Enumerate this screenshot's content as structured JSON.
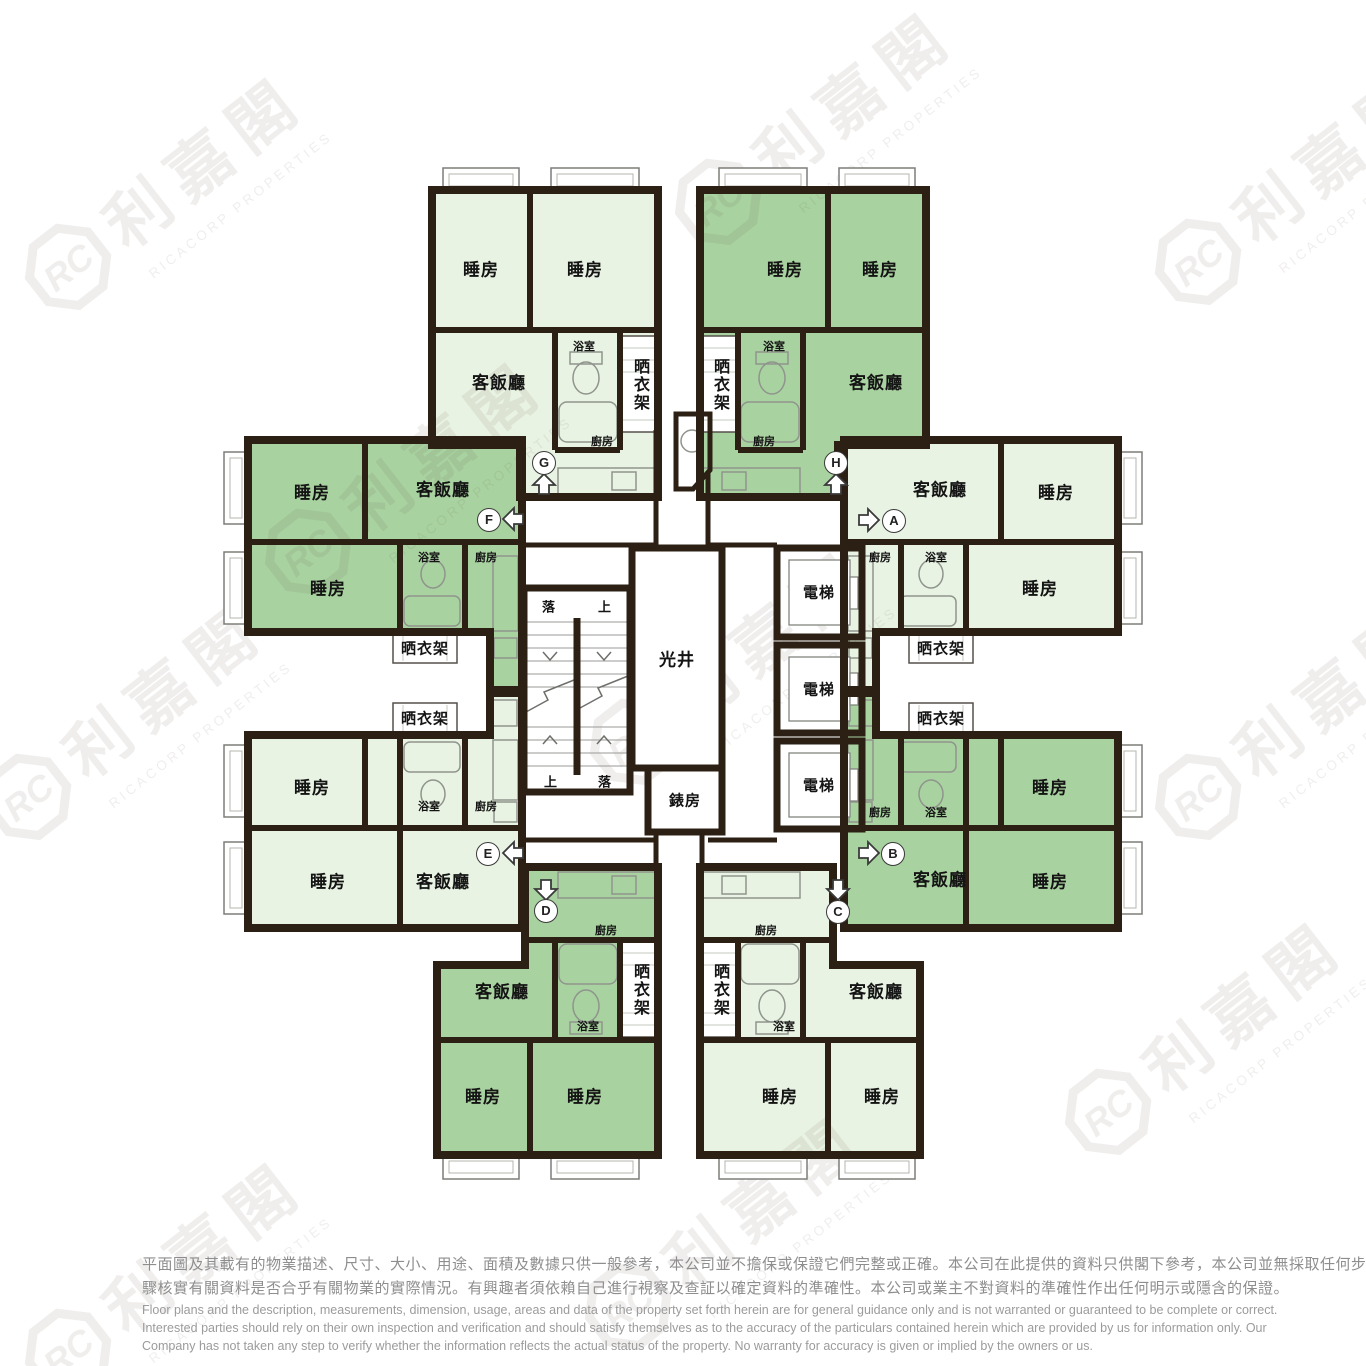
{
  "watermark": {
    "logo": "RC",
    "company_cn": "利嘉閣",
    "company_en": "RICACORP PROPERTIES"
  },
  "units": {
    "letters": [
      "A",
      "B",
      "C",
      "D",
      "E",
      "F",
      "G",
      "H"
    ]
  },
  "room_labels": {
    "bedroom": "睡房",
    "living_dining": "客飯廳",
    "bathroom": "浴室",
    "kitchen": "廚房",
    "drying_rack": "晒衣架",
    "lift": "電梯",
    "light_well": "光井",
    "meter_room": "錶房",
    "stair_up": "上",
    "stair_down": "落"
  },
  "disclaimer": {
    "cn_line1": "平面圖及其載有的物業描述、尺寸、大小、用途、面積及數據只供一般參考，本公司並不擔保或保證它們完整或正確。本公司在此提供的資料只供閣下參考，本公司並無採取任何步",
    "cn_line2": "驟核實有關資料是否合乎有關物業的實際情況。有興趣者須依賴自己進行視察及查証以確定資料的準確性。本公司或業主不對資料的準確性作出任何明示或隱含的保證。",
    "en_line1": "Floor plans and the description, measurements, dimension, usage, areas and data of the property set forth herein are for general guidance only and is not warranted or guaranteed to be complete or correct.",
    "en_line2": "Interested parties should rely on their own inspection and verification and should satisfy themselves as to the accuracy of the particulars contained herein which are provided by us for information only.  Our",
    "en_line3": "Company has not taken any step to verify whether the information reflects the actual status of the property.  No warranty for accuracy is given or implied by the owners or us."
  }
}
